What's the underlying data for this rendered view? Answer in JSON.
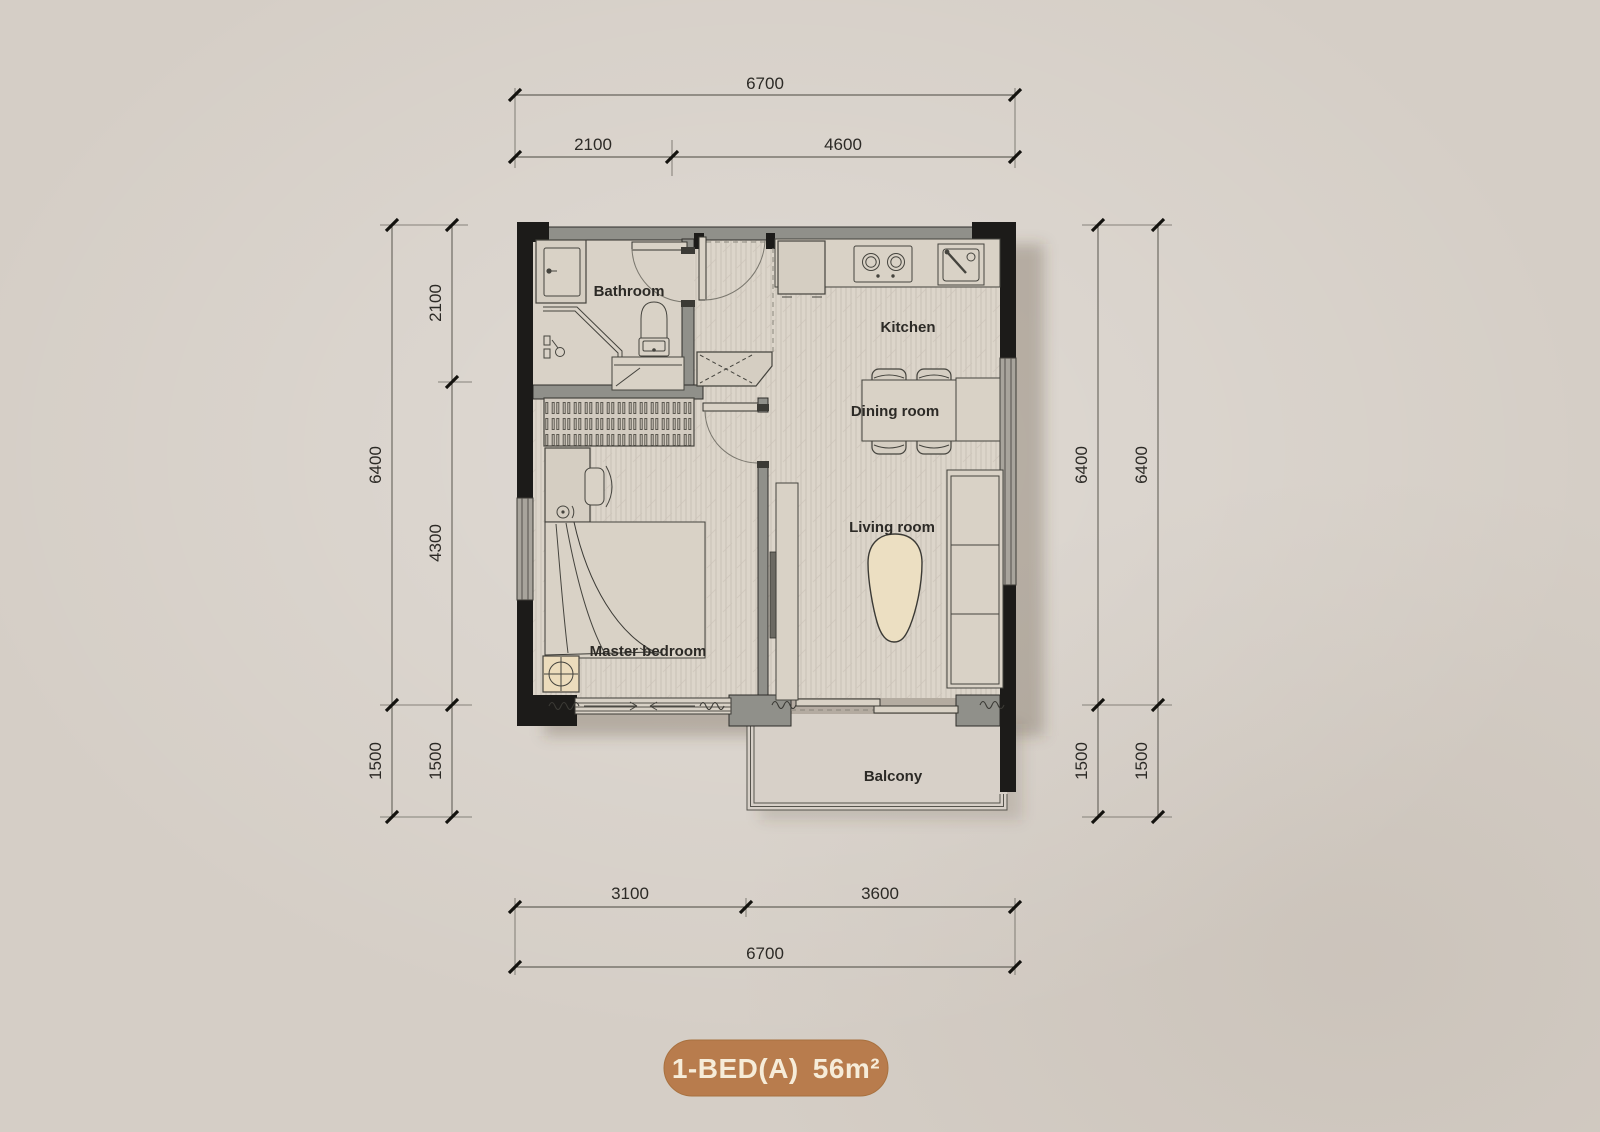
{
  "palette": {
    "background": "#d5cec6",
    "plan_floor": "#dcd5ca",
    "bathroom_floor": "#d9d2c7",
    "wall_black": "#1c1b19",
    "wall_gray": "#90908a",
    "furniture_fill": "#d5cec2",
    "cream": "#ecdfc2",
    "line": "#3b3a35",
    "dim_text": "#2c2a26",
    "badge_bg": "#b87c4d",
    "badge_text": "#f6ecd9"
  },
  "rooms": {
    "bathroom": "Bathroom",
    "kitchen": "Kitchen",
    "dining": "Dining room",
    "living": "Living room",
    "bedroom": "Master bedroom",
    "balcony": "Balcony"
  },
  "dimensions": {
    "top": {
      "overall": "6700",
      "segments": [
        "2100",
        "4600"
      ]
    },
    "bottom": {
      "overall": "6700",
      "segments": [
        "3100",
        "3600"
      ]
    },
    "left": {
      "outer": [
        "6400",
        "1500"
      ],
      "inner": [
        "2100",
        "4300",
        "1500"
      ]
    },
    "right": {
      "near": [
        "6400",
        "1500"
      ],
      "far": [
        "6400",
        "1500"
      ]
    }
  },
  "badge": {
    "name": "1-BED(A)",
    "area": "56m²"
  },
  "symbols": [
    "bed",
    "wardrobe",
    "desk",
    "desk-chair",
    "nightstand-lamp",
    "bathroom-vanity",
    "shower",
    "toilet",
    "washer-bench",
    "shoe-cabinet",
    "fridge",
    "stove",
    "kitchen-sink",
    "dining-table",
    "dining-chair",
    "sideboard",
    "sofa",
    "coffee-table",
    "tv-cabinet",
    "entry-door",
    "bathroom-door",
    "bedroom-door",
    "balcony-sliding-door",
    "window",
    "curtain",
    "balcony-railing"
  ]
}
